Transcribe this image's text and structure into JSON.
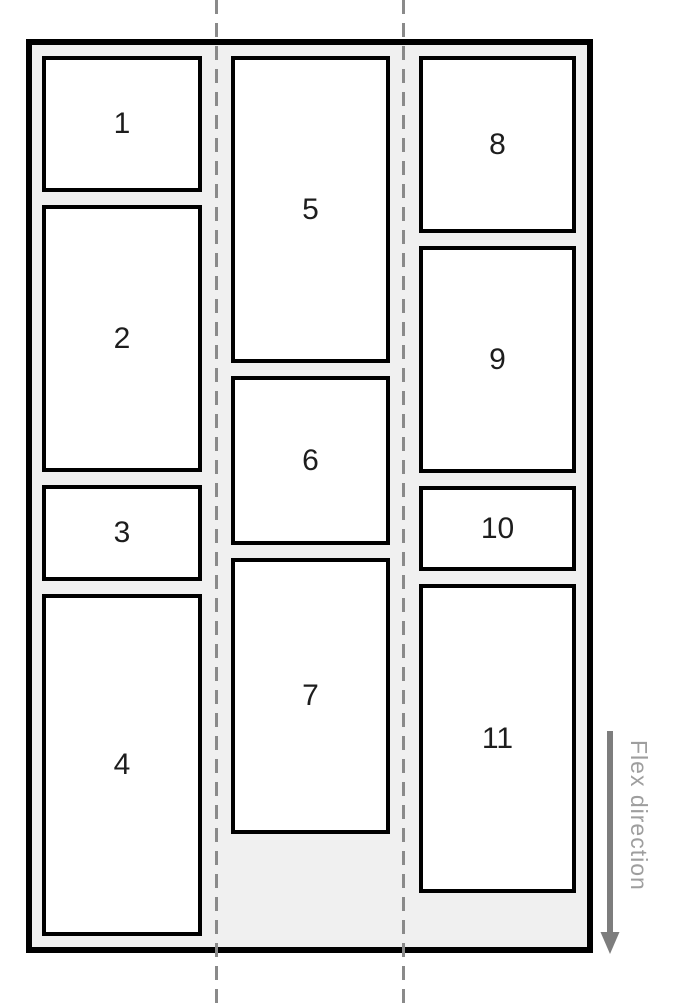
{
  "flex_label": "Flex direction",
  "colors": {
    "container_background": "#f0f0f0",
    "container_border": "#000000",
    "item_background": "#ffffff",
    "item_border": "#000000",
    "item_text": "#1d1d1d",
    "divider_line": "#8a8a8a",
    "arrow": "#7d7d7d",
    "flex_label_text": "#9e9e9e"
  },
  "columns": [
    {
      "name": "column-1",
      "items": [
        {
          "label": "1",
          "height": 136
        },
        {
          "label": "2",
          "height": 267
        },
        {
          "label": "3",
          "height": 96
        },
        {
          "label": "4",
          "height": 342
        }
      ]
    },
    {
      "name": "column-2",
      "items": [
        {
          "label": "5",
          "height": 307
        },
        {
          "label": "6",
          "height": 169
        },
        {
          "label": "7",
          "height": 276
        }
      ]
    },
    {
      "name": "column-3",
      "items": [
        {
          "label": "8",
          "height": 177
        },
        {
          "label": "9",
          "height": 227
        },
        {
          "label": "10",
          "height": 85
        },
        {
          "label": "11",
          "height": 309
        }
      ]
    }
  ]
}
